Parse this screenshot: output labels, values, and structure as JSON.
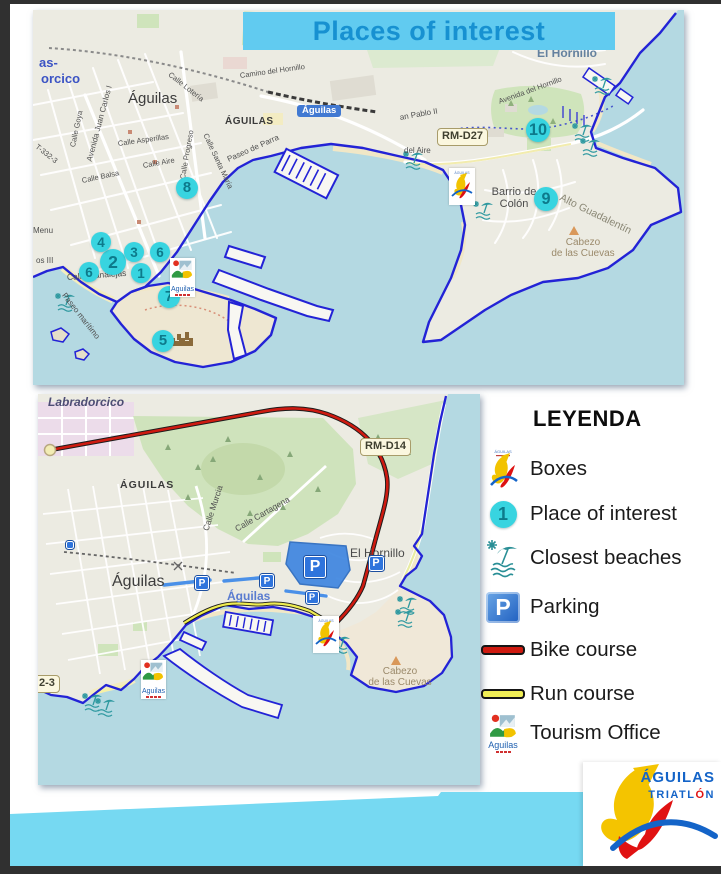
{
  "title": "Places of interest",
  "legend": {
    "title": "LEYENDA",
    "items": [
      {
        "icon": "triathlon-boxes-icon",
        "label": "Boxes"
      },
      {
        "icon": "place-marker-icon",
        "label": "Place of interest",
        "marker_number": "1"
      },
      {
        "icon": "beach-icon",
        "label": "Closest beaches"
      },
      {
        "icon": "parking-icon",
        "label": "Parking",
        "letter": "P"
      },
      {
        "icon": "bike-line-icon",
        "label": "Bike course"
      },
      {
        "icon": "run-line-icon",
        "label": "Run course"
      },
      {
        "icon": "tourism-logo-icon",
        "label": "Tourism Office",
        "logo_text": "Aguilas"
      }
    ]
  },
  "footer_logo": {
    "line1": "ÁGUILAS",
    "line2a": "TRIATL",
    "line2b": "Ó",
    "line2c": "N"
  },
  "colors": {
    "banner_bg": "#61cbf0",
    "banner_text": "#1791d1",
    "marker": "#38d4e0",
    "marker_text": "#0d7a8b",
    "bike_course": "#ce1a10",
    "run_course": "#f0ee55",
    "parking_blue": "#2f74dc",
    "coastline": "#2323d6",
    "water": "#b4d9e2",
    "band": "#76d9f2"
  },
  "top_map": {
    "markers": [
      {
        "n": "1",
        "x": 108,
        "y": 263,
        "r": 10
      },
      {
        "n": "2",
        "x": 80,
        "y": 252,
        "r": 13
      },
      {
        "n": "3",
        "x": 101,
        "y": 242,
        "r": 10
      },
      {
        "n": "4",
        "x": 68,
        "y": 232,
        "r": 10
      },
      {
        "n": "5",
        "x": 130,
        "y": 331,
        "r": 11
      },
      {
        "n": "6",
        "x": 56,
        "y": 262,
        "r": 10
      },
      {
        "n": "6",
        "x": 127,
        "y": 242,
        "r": 10
      },
      {
        "n": "7",
        "x": 136,
        "y": 287,
        "r": 11
      },
      {
        "n": "8",
        "x": 154,
        "y": 178,
        "r": 11
      },
      {
        "n": "9",
        "x": 513,
        "y": 189,
        "r": 12
      },
      {
        "n": "10",
        "x": 505,
        "y": 120,
        "r": 12
      }
    ],
    "labels": [
      {
        "text": "as-",
        "x": 6,
        "y": 46,
        "size": 13,
        "w": 700,
        "color": "#3b53c4"
      },
      {
        "text": "orcico",
        "x": 8,
        "y": 62,
        "size": 13,
        "w": 700,
        "color": "#3b53c4"
      },
      {
        "text": "Águilas",
        "x": 95,
        "y": 81,
        "size": 15,
        "color": "#3c3c3c",
        "name": "city-label"
      },
      {
        "text": "ÁGUILAS",
        "x": 192,
        "y": 106,
        "size": 10,
        "w": 700,
        "ls": 0.5,
        "color": "#3a3a3a"
      },
      {
        "text": "Águilas",
        "x": 264,
        "y": 95,
        "size": 9.5,
        "cls": "station-badge",
        "name": "station-label"
      },
      {
        "text": "El Hornillo",
        "x": 504,
        "y": 37,
        "size": 12,
        "w": 600,
        "color": "#64819f"
      },
      {
        "text": "Camino del Hornillo",
        "x": 207,
        "y": 62,
        "size": 7.5,
        "rot": -8
      },
      {
        "text": "Avenida del Hornillo",
        "x": 466,
        "y": 88,
        "size": 7.5,
        "rot": -20
      },
      {
        "text": "Calle Lotería",
        "x": 136,
        "y": 60,
        "size": 7.5,
        "rot": 38
      },
      {
        "text": "Calle Goya",
        "x": 40,
        "y": 133,
        "size": 7.5,
        "rot": -78
      },
      {
        "text": "Avenida Juan Carlos I",
        "x": 57,
        "y": 147,
        "size": 8,
        "rot": -75
      },
      {
        "text": "Calle Asperillas",
        "x": 85,
        "y": 130,
        "size": 7.5,
        "rot": -8
      },
      {
        "text": "Calle Aire",
        "x": 110,
        "y": 152,
        "size": 7.5,
        "rot": -10
      },
      {
        "text": "Calle Progreso",
        "x": 150,
        "y": 165,
        "size": 7.5,
        "rot": -80
      },
      {
        "text": "Calle Santa María",
        "x": 172,
        "y": 120,
        "size": 7.5,
        "rot": 65
      },
      {
        "text": "Calle Balsa",
        "x": 49,
        "y": 167,
        "size": 7.5,
        "rot": -12
      },
      {
        "text": "Paseo de Parra",
        "x": 195,
        "y": 146,
        "size": 8,
        "rot": -24
      },
      {
        "text": "T-332-3",
        "x": 3,
        "y": 132,
        "size": 7.5,
        "rot": 38
      },
      {
        "text": "Calle Canalejas",
        "x": 34,
        "y": 263,
        "size": 8.5,
        "rot": -4
      },
      {
        "text": "Paseo marítimo",
        "x": 30,
        "y": 280,
        "size": 8,
        "rot": 52
      },
      {
        "text": "Menu",
        "x": 0,
        "y": 217,
        "size": 8
      },
      {
        "text": "os III",
        "x": 3,
        "y": 247,
        "size": 8
      },
      {
        "text": "Barrio de\nColón",
        "x": 450,
        "y": 176,
        "size": 11,
        "color": "#4a4a4a",
        "cls": "ml-center",
        "wd": 62
      },
      {
        "text": "Alto Guadalentín",
        "x": 527,
        "y": 182,
        "size": 10.5,
        "rot": 26,
        "color": "#8a8775"
      },
      {
        "text": "Cabezo\nde las Cuevas",
        "x": 508,
        "y": 227,
        "size": 10,
        "color": "#9b8a6b",
        "cls": "ml-center",
        "wd": 84
      },
      {
        "text": "an Pablo II",
        "x": 367,
        "y": 104,
        "size": 8,
        "rot": -10
      },
      {
        "text": "del Aire",
        "x": 371,
        "y": 137,
        "size": 8
      },
      {
        "text": "RM-D27",
        "x": 404,
        "y": 118,
        "size": 11,
        "cls": "road-badge",
        "name": "road-ref-badge"
      }
    ],
    "logos": [
      {
        "type": "tourism",
        "x": 137,
        "y": 248,
        "text": "Aguilas"
      },
      {
        "type": "boxes",
        "x": 416,
        "y": 158,
        "text": "ÁGUILAS"
      }
    ]
  },
  "bottom_map": {
    "p_markers": [
      {
        "x": 277,
        "y": 173,
        "s": 22,
        "letter": "P"
      },
      {
        "x": 338,
        "y": 169,
        "s": 15,
        "letter": "P"
      },
      {
        "x": 164,
        "y": 189,
        "s": 14,
        "letter": "P"
      },
      {
        "x": 229,
        "y": 187,
        "s": 14,
        "letter": "P"
      },
      {
        "x": 274,
        "y": 203,
        "s": 13,
        "letter": "P"
      },
      {
        "x": 32,
        "y": 151,
        "s": 8,
        "letter": ""
      }
    ],
    "labels": [
      {
        "text": "Labradorcico",
        "x": 10,
        "y": 2,
        "size": 12,
        "italic": 1,
        "w": 600,
        "color": "#4d4d74"
      },
      {
        "text": "ÁGUILAS",
        "x": 82,
        "y": 86,
        "size": 10.5,
        "w": 700,
        "ls": 1,
        "color": "#3a3a3a"
      },
      {
        "text": "Águilas",
        "x": 74,
        "y": 179,
        "size": 16,
        "color": "#3c3c3c",
        "name": "city-label"
      },
      {
        "text": "Calle Murcia",
        "x": 168,
        "y": 132,
        "size": 8.5,
        "rot": -72
      },
      {
        "text": "Calle Cartagena",
        "x": 198,
        "y": 131,
        "size": 8.5,
        "rot": -30
      },
      {
        "text": "El Hornillo",
        "x": 312,
        "y": 153,
        "size": 12,
        "color": "#4a4a4a"
      },
      {
        "text": "Águilas",
        "x": 189,
        "y": 196,
        "size": 12,
        "w": 600,
        "color": "#5a7cd0",
        "name": "water-label"
      },
      {
        "text": "Cabezo\nde las Cuevas",
        "x": 320,
        "y": 272,
        "size": 10,
        "color": "#9b8a6b",
        "cls": "ml-center",
        "wd": 84
      },
      {
        "text": "RM-D14",
        "x": 322,
        "y": 44,
        "size": 11,
        "cls": "road-badge",
        "name": "road-ref-badge"
      },
      {
        "text": "2-3",
        "x": -4,
        "y": 281,
        "size": 11,
        "cls": "road-badge",
        "name": "road-ref-badge"
      }
    ],
    "logos": [
      {
        "type": "tourism",
        "x": 103,
        "y": 266,
        "text": "Aguilas"
      },
      {
        "type": "boxes",
        "x": 275,
        "y": 222,
        "text": "ÁGUILAS"
      }
    ]
  }
}
